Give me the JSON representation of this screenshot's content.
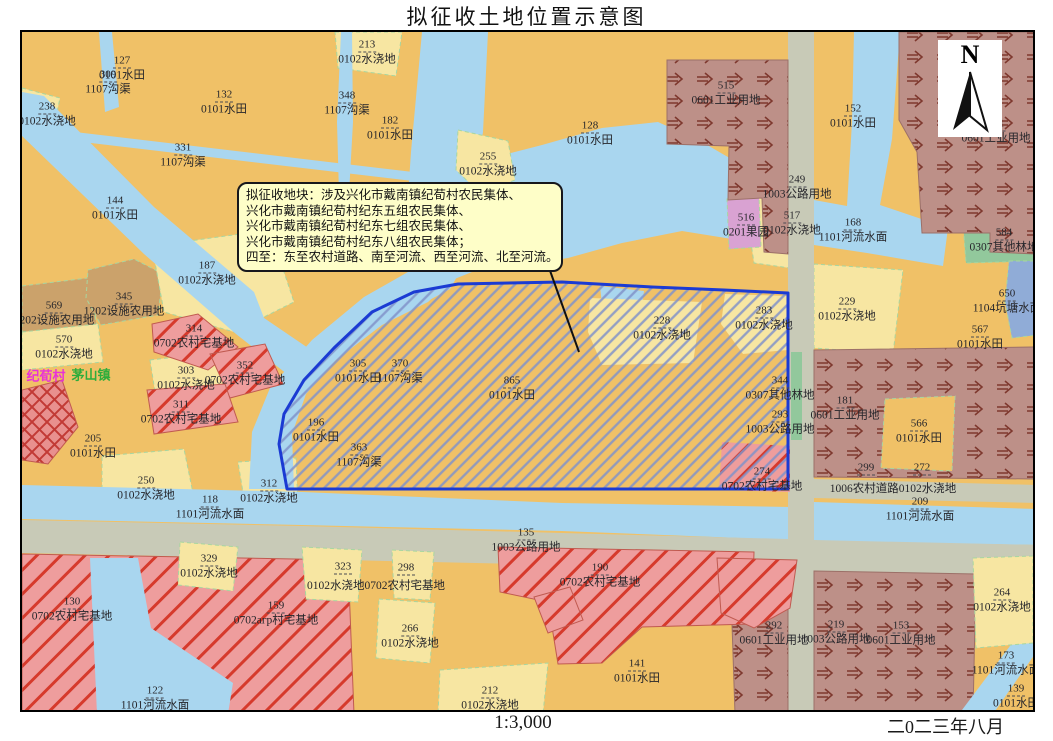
{
  "title": "拟征收土地位置示意图",
  "footer": {
    "scale": "1:3,000",
    "date": "二0二三年八月"
  },
  "north": {
    "letter": "N"
  },
  "callout": {
    "lines": [
      "拟征收地块：涉及兴化市戴南镇纪荀村农民集体、",
      "兴化市戴南镇纪荀村纪东五组农民集体、",
      "兴化市戴南镇纪荀村纪东七组农民集体、",
      "兴化市戴南镇纪荀村纪东八组农民集体；",
      "四至：东至农村道路、南至河流、西至河流、北至河流。"
    ]
  },
  "colors": {
    "paddy_orange": "#F0C167",
    "irrigated_yellow": "#F7E6A2",
    "water_blue": "#A9D6EF",
    "road_gray": "#C8CAB7",
    "industrial_brown": "#BD9088",
    "industrial_arrow": "#7E382E",
    "homestead_pink": "#EE9D9D",
    "homestead_line_red": "#D63A2C",
    "facility_tan": "#CBA26B",
    "forest_green": "#92C89C",
    "pond_blue": "#90ACD7",
    "orchard_magenta": "#D9A2D2",
    "zone_hatch": "#8193C9",
    "zone_border": "#1B3BD3",
    "callout_bg": "#FEFEC8"
  },
  "map": {
    "place_names": [
      {
        "text": "纪荀村",
        "color": "#E832D8",
        "x": 44,
        "y": 373
      },
      {
        "text": "茅山镇",
        "color": "#2EAD3B",
        "x": 89,
        "y": 372
      }
    ],
    "labels": [
      {
        "num": "127",
        "type": "0101水田",
        "x": 120,
        "y": 66
      },
      {
        "num": "309",
        "type": "1107沟渠",
        "x": 106,
        "y": 80
      },
      {
        "num": "238",
        "type": "0102水浇地",
        "x": 45,
        "y": 112
      },
      {
        "num": "213",
        "type": "0102水浇地",
        "x": 365,
        "y": 50
      },
      {
        "num": "132",
        "type": "0101水田",
        "x": 222,
        "y": 100
      },
      {
        "num": "331",
        "type": "1107沟渠",
        "x": 181,
        "y": 153
      },
      {
        "num": "348",
        "type": "1107沟渠",
        "x": 345,
        "y": 101
      },
      {
        "num": "182",
        "type": "0101水田",
        "x": 388,
        "y": 126
      },
      {
        "num": "255",
        "type": "0102水浇地",
        "x": 486,
        "y": 162
      },
      {
        "num": "128",
        "type": "0101水田",
        "x": 588,
        "y": 131
      },
      {
        "num": "515",
        "type": "0601工业用地",
        "x": 724,
        "y": 91
      },
      {
        "num": "152",
        "type": "0101水田",
        "x": 851,
        "y": 114
      },
      {
        "num": "531",
        "type": "0601工业用地",
        "x": 994,
        "y": 129
      },
      {
        "num": "584",
        "type": "0307其他林地",
        "x": 1002,
        "y": 238
      },
      {
        "num": "650",
        "type": "1104坑塘水面",
        "x": 1005,
        "y": 299
      },
      {
        "num": "567",
        "type": "0101水田",
        "x": 978,
        "y": 335
      },
      {
        "num": "144",
        "type": "0101水田",
        "x": 113,
        "y": 206
      },
      {
        "num": "187",
        "type": "0102水浇地",
        "x": 205,
        "y": 271
      },
      {
        "num": "345",
        "type": "1202设施农用地",
        "x": 122,
        "y": 302
      },
      {
        "num": "569",
        "type": "1202设施农用地",
        "x": 52,
        "y": 311
      },
      {
        "num": "570",
        "type": "0102水浇地",
        "x": 62,
        "y": 345
      },
      {
        "num": "314",
        "type": "0702农村宅基地",
        "x": 192,
        "y": 334
      },
      {
        "num": "352",
        "type": "0702农村宅基地",
        "x": 243,
        "y": 371
      },
      {
        "num": "303",
        "type": "0102水浇地",
        "x": 184,
        "y": 376
      },
      {
        "num": "311",
        "type": "0702农村宅基地",
        "x": 179,
        "y": 410
      },
      {
        "num": "205",
        "type": "0101水田",
        "x": 91,
        "y": 444
      },
      {
        "num": "250",
        "type": "0102水浇地",
        "x": 144,
        "y": 486
      },
      {
        "num": "118",
        "type": "1101河流水面",
        "x": 208,
        "y": 505
      },
      {
        "num": "312",
        "type": "0102水浇地",
        "x": 267,
        "y": 489
      },
      {
        "num": "305",
        "type": "0101水田",
        "x": 356,
        "y": 369
      },
      {
        "num": "370",
        "type": "1107沟渠",
        "x": 398,
        "y": 369
      },
      {
        "num": "865",
        "type": "0101水田",
        "x": 510,
        "y": 386
      },
      {
        "num": "196",
        "type": "0101水田",
        "x": 314,
        "y": 428
      },
      {
        "num": "363",
        "type": "1107沟渠",
        "x": 357,
        "y": 453
      },
      {
        "num": "228",
        "type": "0102水浇地",
        "x": 660,
        "y": 326
      },
      {
        "num": "283",
        "type": "0102水浇地",
        "x": 762,
        "y": 316
      },
      {
        "num": "344",
        "type": "0307其他林地",
        "x": 778,
        "y": 386
      },
      {
        "num": "293",
        "type": "1003公路用地",
        "x": 778,
        "y": 420
      },
      {
        "num": "274",
        "type": "0702农村宅基地",
        "x": 760,
        "y": 477
      },
      {
        "num": "181",
        "type": "0601工业用地",
        "x": 843,
        "y": 406
      },
      {
        "num": "229",
        "type": "0102水浇地",
        "x": 845,
        "y": 307
      },
      {
        "num": "566",
        "type": "0101水田",
        "x": 917,
        "y": 429
      },
      {
        "num": "299",
        "type": "",
        "x": 864,
        "y": 467
      },
      {
        "num": "272",
        "type": "",
        "x": 920,
        "y": 467
      },
      {
        "num": "",
        "type": "1006农村道路0102水浇地",
        "x": 891,
        "y": 487
      },
      {
        "num": "209",
        "type": "1101河流水面",
        "x": 918,
        "y": 507
      },
      {
        "num": "249",
        "type": "1003公路用地",
        "x": 795,
        "y": 185
      },
      {
        "num": "516",
        "type": "0201果园",
        "x": 744,
        "y": 223
      },
      {
        "num": "517",
        "type": "0102水浇地",
        "x": 790,
        "y": 221
      },
      {
        "num": "168",
        "type": "1101河流水面",
        "x": 851,
        "y": 228
      },
      {
        "num": "329",
        "type": "0102水浇地",
        "x": 207,
        "y": 564
      },
      {
        "num": "323",
        "type": "",
        "x": 341,
        "y": 566
      },
      {
        "num": "",
        "type": "0102水浇地0702农村宅基地",
        "x": 374,
        "y": 584
      },
      {
        "num": "298",
        "type": "",
        "x": 404,
        "y": 567
      },
      {
        "num": "159",
        "type": "0702агр村宅基地",
        "x": 274,
        "y": 611
      },
      {
        "num": "266",
        "type": "0102水浇地",
        "x": 408,
        "y": 634
      },
      {
        "num": "130",
        "type": "0702农村宅基地",
        "x": 70,
        "y": 607
      },
      {
        "num": "122",
        "type": "1101河流水面",
        "x": 153,
        "y": 696
      },
      {
        "num": "135",
        "type": "1003公路用地",
        "x": 524,
        "y": 538
      },
      {
        "num": "190",
        "type": "0702农村宅基地",
        "x": 598,
        "y": 573
      },
      {
        "num": "212",
        "type": "0102水浇地",
        "x": 488,
        "y": 696
      },
      {
        "num": "141",
        "type": "0101水田",
        "x": 635,
        "y": 669
      },
      {
        "num": "292",
        "type": "0601工业用地",
        "x": 772,
        "y": 631
      },
      {
        "num": "219",
        "type": "1003公路用地",
        "x": 834,
        "y": 630
      },
      {
        "num": "153",
        "type": "0601工业用地",
        "x": 899,
        "y": 631
      },
      {
        "num": "264",
        "type": "0102水浇地",
        "x": 1000,
        "y": 598
      },
      {
        "num": "173",
        "type": "1101河流水面",
        "x": 1004,
        "y": 661
      },
      {
        "num": "139",
        "type": "0101水田",
        "x": 1014,
        "y": 694
      }
    ]
  }
}
